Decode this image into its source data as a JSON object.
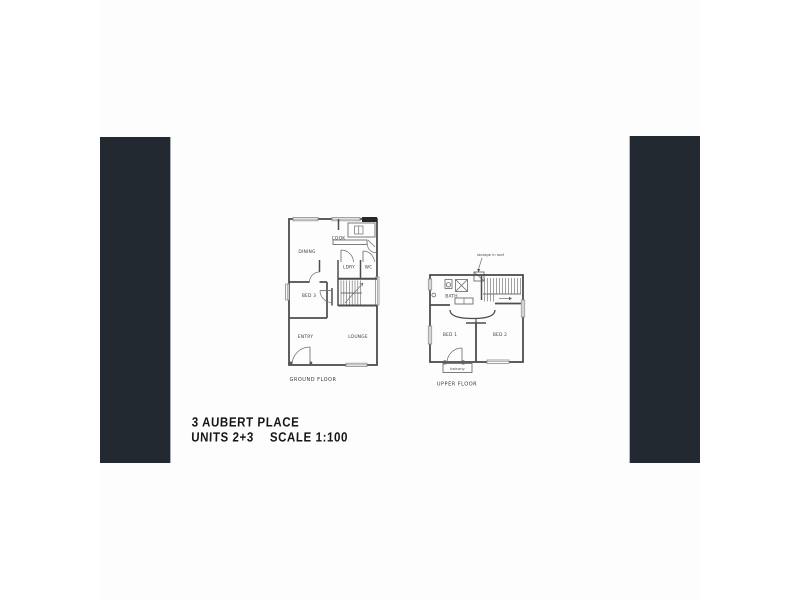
{
  "sheet": {
    "bar_color": "#232931",
    "line_color": "#4d4d4d"
  },
  "title_block": {
    "address": "3 AUBERT PLACE",
    "units": "UNITS 2+3",
    "scale": "SCALE 1:100"
  },
  "ground_floor": {
    "caption": "GROUND FLOOR",
    "labels": {
      "cook": "COOK",
      "dining": "DINING",
      "ldry": "LDRY",
      "wc": "WC",
      "bed3": "BED 3",
      "entry": "ENTRY",
      "lounge": "LOUNGE"
    }
  },
  "upper_floor": {
    "caption": "UPPER FLOOR",
    "annotation": "storage in roof",
    "labels": {
      "bath": "BATH",
      "bed1": "BED 1",
      "bed2": "BED 2",
      "balcony": "balcony"
    }
  }
}
